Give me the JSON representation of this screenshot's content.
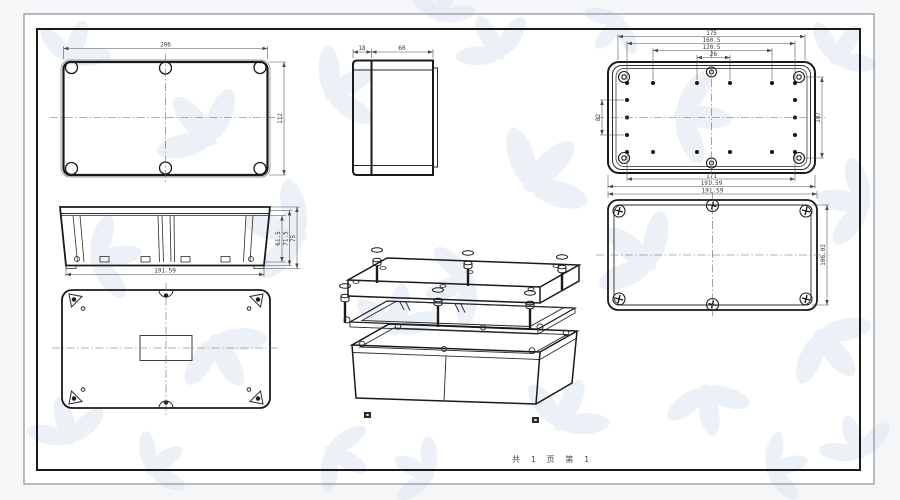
{
  "colors": {
    "line": "#1a1a1a",
    "dim_text": "#3a3a3a",
    "watermark": "#dce6f1",
    "border_outer": "#b9bfc6",
    "sheet_background": "#ffffff"
  },
  "page": {
    "footer": "共 1 页  第 1"
  },
  "views": {
    "lid_inside": {
      "dim_width": "206",
      "dim_height": "112"
    },
    "side": {
      "dim_lid": "18",
      "dim_body": "60"
    },
    "box_inside": {
      "dim_top_1": "175",
      "dim_top_2": "160.5",
      "dim_top_3": "120.5",
      "dim_top_4": "26",
      "dim_left": "82",
      "dim_right": "107",
      "dim_bottom_1": "171",
      "dim_bottom_2": "191.59"
    },
    "body_front": {
      "dim_h1": "61.5",
      "dim_h2": "71.5",
      "dim_h3": "75",
      "dim_bottom": "191.59"
    },
    "lid_outside": {
      "dim_top": "191.59",
      "dim_right": "106.03"
    }
  }
}
